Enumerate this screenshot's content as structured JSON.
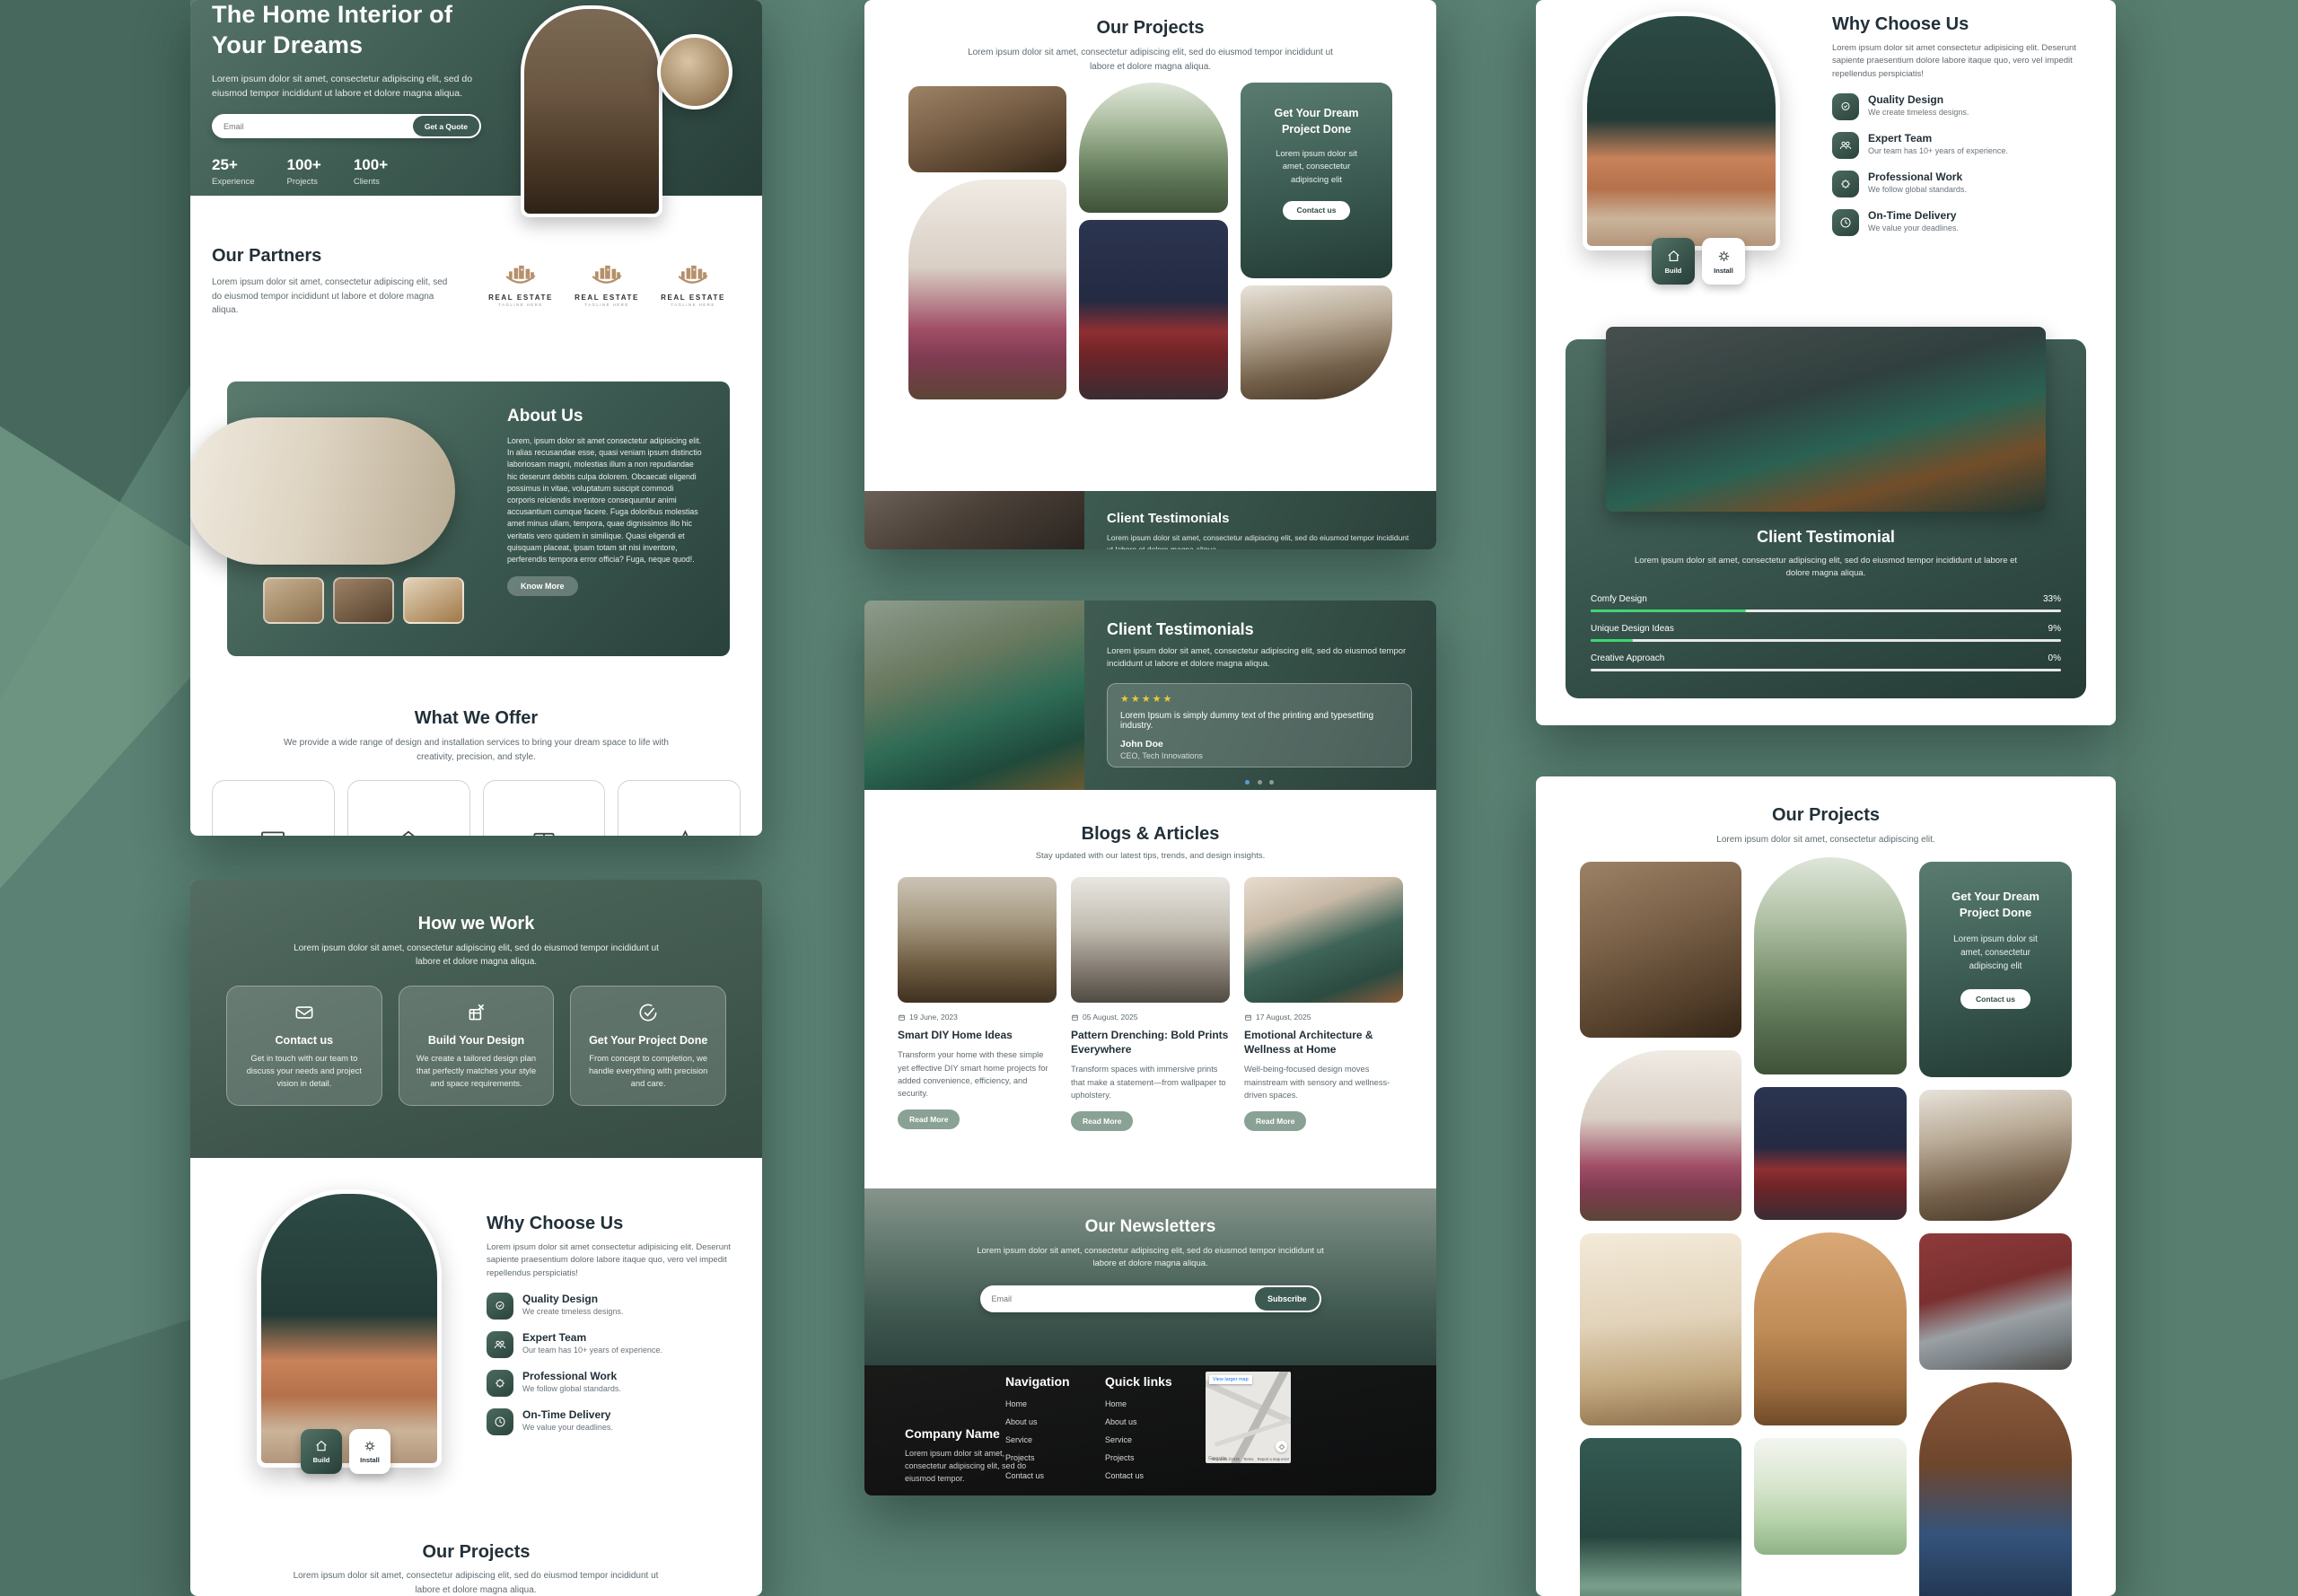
{
  "colors": {
    "background_green": "#5A8173",
    "dark_green": "#2F4A43",
    "accent_tan": "#B5906A",
    "star_yellow": "#E9C93B",
    "progress_green": "#41D473",
    "sage_button": "#8AA295",
    "dot_active": "#5B9BD5"
  },
  "hero": {
    "title": "The Home Interior of Your Dreams",
    "subtitle": "Lorem ipsum dolor sit amet, consectetur adipiscing elit, sed do eiusmod tempor incididunt ut labore et dolore magna aliqua.",
    "email_placeholder": "Email",
    "cta": "Get a Quote",
    "stats": [
      {
        "value": "25+",
        "label": "Experience"
      },
      {
        "value": "100+",
        "label": "Projects"
      },
      {
        "value": "100+",
        "label": "Clients"
      }
    ]
  },
  "partners": {
    "title": "Our Partners",
    "description": "Lorem ipsum dolor sit amet, consectetur adipiscing elit, sed do eiusmod tempor incididunt ut labore et dolore magna aliqua.",
    "logos": [
      {
        "name": "REAL ESTATE",
        "tagline": "TAGLINE HERE"
      },
      {
        "name": "REAL ESTATE",
        "tagline": "TAGLINE HERE"
      },
      {
        "name": "REAL ESTATE",
        "tagline": "TAGLINE HERE"
      }
    ]
  },
  "about": {
    "title": "About Us",
    "body": "Lorem, ipsum dolor sit amet consectetur adipisicing elit. In alias recusandae esse, quasi veniam ipsum distinctio laboriosam magni, molestias illum a non repudiandae hic deserunt debitis culpa dolorem. Obcaecati eligendi possimus in vitae, voluptatum suscipit commodi corporis reiciendis inventore consequuntur animi accusantium cumque facere. Fuga doloribus molestias amet minus ullam, tempora, quae dignissimos illo hic veritatis vero quidem in similique. Quasi eligendi et quisquam placeat, ipsam totam sit nisi inventore, perferendis tempora error officia? Fuga, neque quod!.",
    "cta": "Know More"
  },
  "offer": {
    "title": "What We Offer",
    "subtitle": "We provide a wide range of design and installation services to bring your dream space to life with creativity, precision, and style."
  },
  "how_we_work": {
    "title": "How we Work",
    "subtitle": "Lorem ipsum dolor sit amet, consectetur adipiscing elit, sed do eiusmod tempor incididunt ut labore et dolore magna aliqua.",
    "steps": [
      {
        "title": "Contact us",
        "body": "Get in touch with our team to discuss your needs and project vision in detail."
      },
      {
        "title": "Build Your Design",
        "body": "We create a tailored design plan that perfectly matches your style and space requirements."
      },
      {
        "title": "Get Your Project Done",
        "body": "From concept to completion, we handle everything with precision and care."
      }
    ]
  },
  "why_choose": {
    "title": "Why Choose Us",
    "intro": "Lorem ipsum dolor sit amet consectetur adipisicing elit. Deserunt sapiente praesentium dolore labore itaque quo, vero vel impedit repellendus perspiciatis!",
    "features": [
      {
        "title": "Quality Design",
        "body": "We create timeless designs."
      },
      {
        "title": "Expert Team",
        "body": "Our team has 10+ years of experience."
      },
      {
        "title": "Professional Work",
        "body": "We follow global standards."
      },
      {
        "title": "On-Time Delivery",
        "body": "We value your deadlines."
      }
    ],
    "build_label": "Build",
    "install_label": "Install"
  },
  "projects_gallery": {
    "title": "Our Projects",
    "subtitle_long": "Lorem ipsum dolor sit amet, consectetur adipiscing elit, sed do eiusmod tempor incididunt ut labore et dolore magna aliqua.",
    "subtitle_short": "Lorem ipsum dolor sit amet, consectetur adipiscing elit."
  },
  "dream_card": {
    "title": "Get Your Dream Project Done",
    "body": "Lorem ipsum dolor sit amet, consectetur adipiscing elit",
    "cta": "Contact us"
  },
  "testimonials": {
    "title": "Client Testimonials",
    "subtitle": "Lorem ipsum dolor sit amet, consectetur adipiscing elit, sed do eiusmod tempor incididunt ut labore et dolore magna aliqua.",
    "stars": "★★★★★",
    "quote": "Lorem Ipsum is simply dummy text of the printing and typesetting industry.",
    "name": "John Doe",
    "role": "CEO, Tech Innovations"
  },
  "testimonial_single": {
    "title": "Client Testimonial",
    "subtitle": "Lorem ipsum dolor sit amet, consectetur adipiscing elit, sed do eiusmod tempor incididunt ut labore et dolore magna aliqua.",
    "bars": [
      {
        "label": "Comfy Design",
        "value": "33%",
        "pct": 33
      },
      {
        "label": "Unique Design Ideas",
        "value": "9%",
        "pct": 9
      },
      {
        "label": "Creative Approach",
        "value": "0%",
        "pct": 0
      }
    ]
  },
  "blogs": {
    "title": "Blogs & Articles",
    "subtitle": "Stay updated with our latest tips, trends, and design insights.",
    "read_more": "Read More",
    "posts": [
      {
        "date": "19 June, 2023",
        "title": "Smart DIY Home Ideas",
        "body": "Transform your home with these simple yet effective DIY smart home projects for added convenience, efficiency, and security."
      },
      {
        "date": "05 August, 2025",
        "title": "Pattern Drenching: Bold Prints Everywhere",
        "body": "Transform spaces with immersive prints that make a statement—from wallpaper to upholstery."
      },
      {
        "date": "17 August, 2025",
        "title": "Emotional Architecture & Wellness at Home",
        "body": "Well-being-focused design moves mainstream with sensory and wellness-driven spaces."
      }
    ]
  },
  "newsletter": {
    "title": "Our Newsletters",
    "subtitle": "Lorem ipsum dolor sit amet, consectetur adipiscing elit, sed do eiusmod tempor incididunt ut labore et dolore magna aliqua.",
    "email_placeholder": "Email",
    "cta": "Subscribe"
  },
  "footer": {
    "company": "Company Name",
    "company_desc": "Lorem ipsum dolor sit amet, consectetur adipiscing elit, sed do eiusmod tempor.",
    "nav_title": "Navigation",
    "quick_title": "Quick links",
    "links": [
      "Home",
      "About us",
      "Service",
      "Projects",
      "Contact us"
    ],
    "map": {
      "view_larger": "View larger map",
      "google": "Google",
      "attribution": "Map data ©2025",
      "terms": "Terms",
      "report": "Report a map error"
    }
  }
}
